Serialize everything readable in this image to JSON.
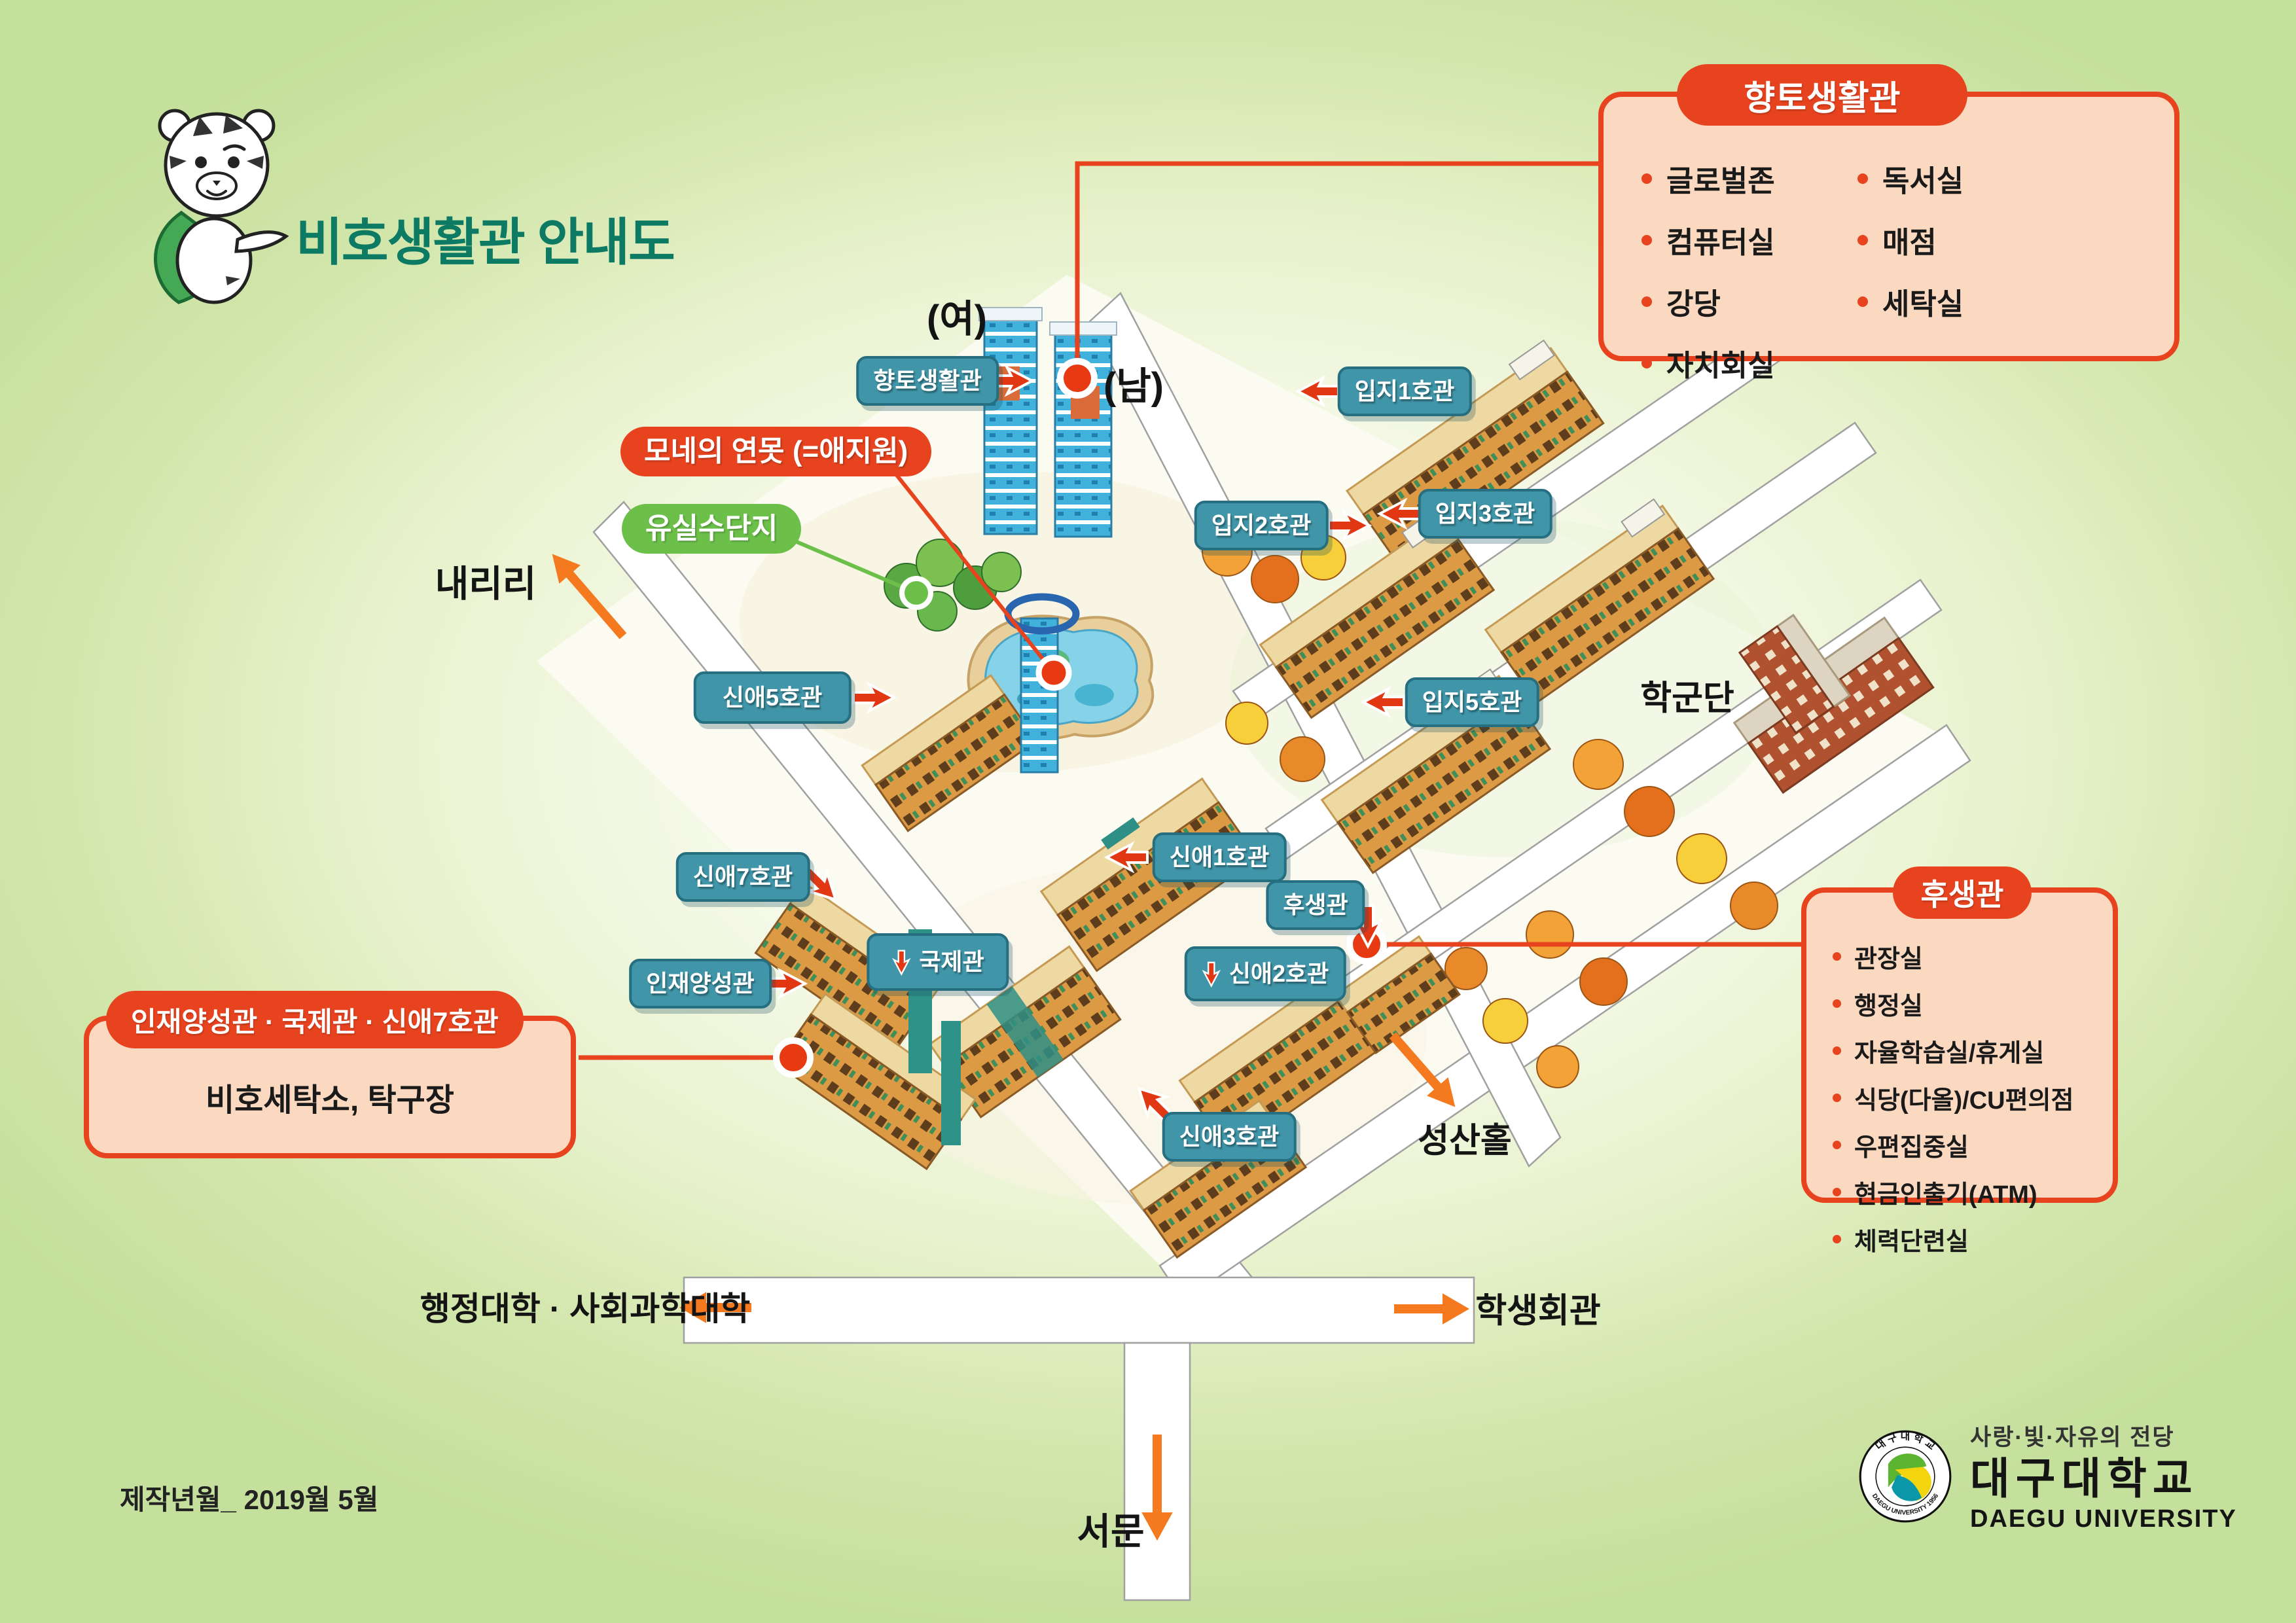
{
  "title": "비호생활관 안내도",
  "labels": {
    "yeo": "(여)",
    "nam": "(남)",
    "naeriri": "내리리",
    "hakgundan": "학군단",
    "seongsan_hall": "성산홀",
    "admin_college": "행정대학 · 사회과학대학",
    "student_union": "학생회관",
    "west_gate": "서문"
  },
  "badges": {
    "hyangto": "향토생활관",
    "ipji1": "입지1호관",
    "ipji2": "입지2호관",
    "ipji3": "입지3호관",
    "ipji5": "입지5호관",
    "shinae5": "신애5호관",
    "shinae1": "신애1호관",
    "husaeng": "후생관",
    "shinae2": "신애2호관",
    "gukje": "국제관",
    "shinae3": "신애3호관",
    "shinae7": "신애7호관",
    "injae": "인재양성관"
  },
  "pills": {
    "pond": "모네의 연못 (=애지원)",
    "orchard": "유실수단지"
  },
  "callouts": {
    "hyangto": {
      "title": "향토생활관",
      "col1": [
        "글로벌존",
        "컴퓨터실",
        "강당",
        "자치회실"
      ],
      "col2": [
        "독서실",
        "매점",
        "세탁실"
      ]
    },
    "injae": {
      "title": "인재양성관 · 국제관 · 신애7호관",
      "body": "비호세탁소, 탁구장"
    },
    "husaeng": {
      "title": "후생관",
      "items": [
        "관장실",
        "행정실",
        "자율학습실/휴게실",
        "식당(다올)/CU편의점",
        "우편집중실",
        "현금인출기(ATM)",
        "체력단련실"
      ]
    }
  },
  "footer": {
    "production_note": "제작년월_ 2019월 5월"
  },
  "logo": {
    "motto": "사랑·빛·자유의 전당",
    "name_kr": "대구대학교",
    "name_en": "DAEGU UNIVERSITY",
    "seal_top": "대 구 대 학 교",
    "seal_bottom": "DAEGU UNIVERSITY 1956"
  },
  "colors": {
    "accent_orange": "#e8431f",
    "arrow_orange": "#f4791f",
    "badge_teal": "#4095a8",
    "pill_green": "#6cc04a",
    "title_teal": "#0d7a64",
    "callout_bg": "#fbd8c0"
  }
}
